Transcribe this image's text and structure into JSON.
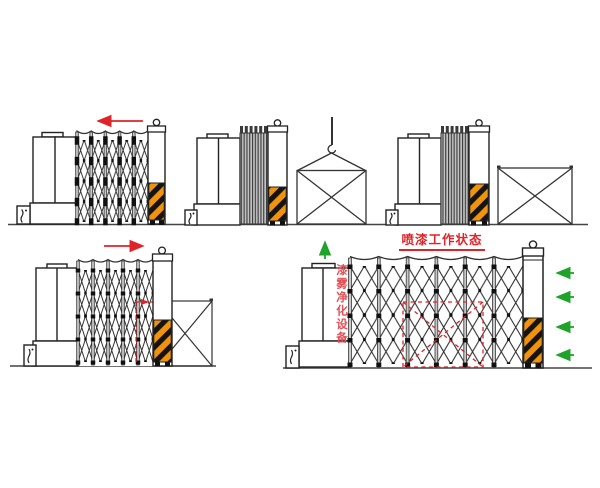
{
  "canvas": {
    "width": 600,
    "height": 488,
    "background": "#ffffff"
  },
  "colors": {
    "line": "#222222",
    "red_accent": "#e02328",
    "green_accent": "#1fa32a",
    "hazard_orange": "#f1940c",
    "hazard_black": "#141414",
    "pleat_gray": "#c2c2c2",
    "post_gray": "#c8c8c8"
  },
  "labels": {
    "working_state_title": "喷漆工作状态",
    "purifier_unit_vertical": "漆雾净化设备"
  },
  "figures": [
    {
      "id": "top-left",
      "state": "booth-retracting",
      "icons": [
        "red-arrow-left-icon",
        "purifier-cabinet",
        "pump-box-icon",
        "folding-booth-lattice",
        "end-column",
        "hazard-stripe-block",
        "wheels-icon",
        "ground-line"
      ]
    },
    {
      "id": "top-middle",
      "state": "booth-collapsed-crate-lifted",
      "icons": [
        "purifier-cabinet",
        "pump-box-icon",
        "collapsed-pleats",
        "end-column",
        "hazard-stripe-block",
        "crane-hook-icon",
        "crate-cross-box"
      ]
    },
    {
      "id": "top-right",
      "state": "booth-collapsed-crate-on-ground",
      "icons": [
        "purifier-cabinet",
        "pump-box-icon",
        "collapsed-pleats",
        "end-column",
        "hazard-stripe-block",
        "crate-cross-box"
      ]
    },
    {
      "id": "bottom-left",
      "state": "booth-extending-over-crate",
      "icons": [
        "red-arrow-right-icon",
        "purifier-cabinet",
        "pump-box-icon",
        "folding-booth-lattice",
        "end-column",
        "hazard-stripe-block",
        "crate-cross-box",
        "red-dashed-guide"
      ]
    },
    {
      "id": "bottom-right",
      "state": "spray-painting-working-state",
      "icons": [
        "green-arrow-up-icon",
        "green-arrow-left-icon",
        "purifier-cabinet",
        "pump-box-icon",
        "folding-booth-lattice",
        "end-column",
        "hazard-stripe-block",
        "crate-dashed-outline",
        "ground-line"
      ]
    }
  ]
}
